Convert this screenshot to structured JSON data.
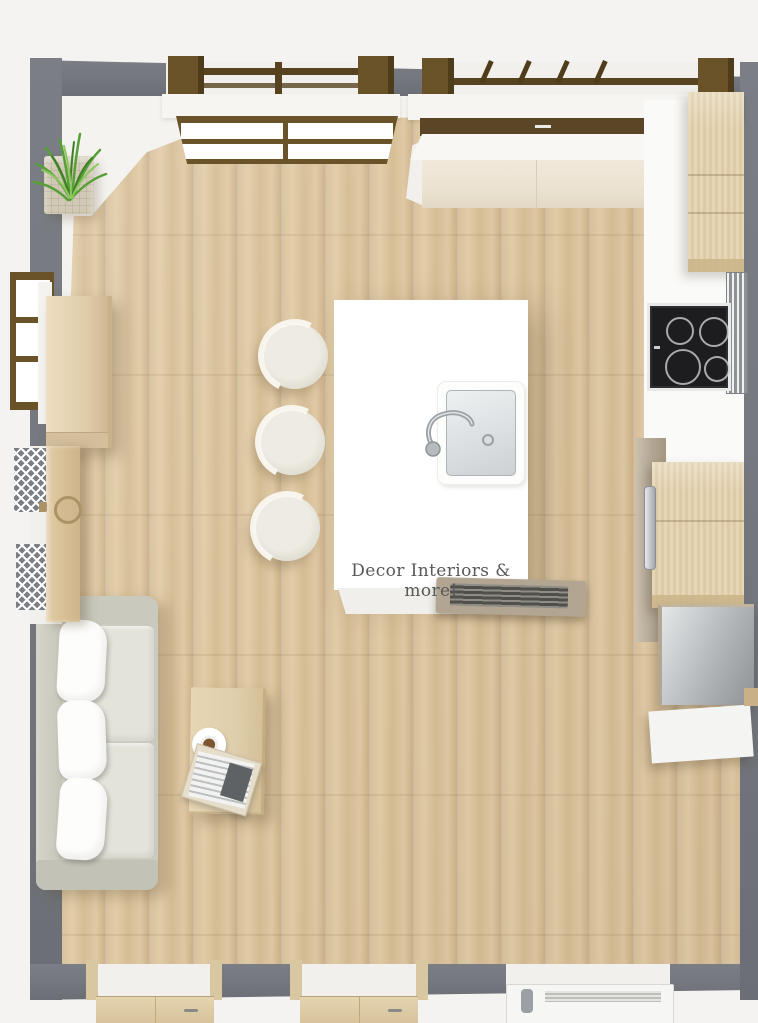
{
  "watermark": {
    "text": "Decor Interiors & more!"
  },
  "colors": {
    "outside": "#f4f3f1",
    "wall": "#73777d",
    "floor_light": "#e2cda9",
    "floor_mid": "#d9c29c",
    "floor_dark": "#cdb28a",
    "island": "#ffffff",
    "cream": "#ece3d2",
    "wood": "#e3d2b1",
    "wood_dark": "#cab488",
    "taupe": "#b2a693",
    "cooktop": "#1d1d20",
    "steel": "#aeb2b5",
    "sofa_frame": "#c9c9bd",
    "sofa_seat": "#e3e3d9",
    "pillow": "#fdfdfc",
    "table": "#e0cfad",
    "frame_brown": "#6b5329",
    "rail_brown": "#57431f",
    "plant": "#5ca53c",
    "brass": "#ab9367",
    "text": "#585858"
  },
  "items": [
    {
      "name": "kitchen-island",
      "features": [
        "sink",
        "faucet",
        "vent-grille",
        "watermark-label"
      ]
    },
    {
      "name": "bar-stool",
      "count": 3
    },
    {
      "name": "cooktop",
      "burners": 4
    },
    {
      "name": "kitchen-counter-top-wall"
    },
    {
      "name": "tall-cabinet-top-right"
    },
    {
      "name": "lower-wood-cabinet-right"
    },
    {
      "name": "steel-oven"
    },
    {
      "name": "white-base-cabinet"
    },
    {
      "name": "sofa",
      "pillows": 3,
      "seat-cushions": 2
    },
    {
      "name": "coffee-table",
      "props": [
        "coffee-cup-on-plate",
        "magazine-stack"
      ]
    },
    {
      "name": "sideboard"
    },
    {
      "name": "potted-grass-plant"
    },
    {
      "name": "window-with-railing",
      "count": 2
    },
    {
      "name": "side-window-left"
    },
    {
      "name": "side-window-right-blinds"
    },
    {
      "name": "door-left-open",
      "hardware": [
        "round-brass-knob"
      ]
    },
    {
      "name": "bottom-door",
      "count": 2
    },
    {
      "name": "bottom-window-unit"
    }
  ]
}
